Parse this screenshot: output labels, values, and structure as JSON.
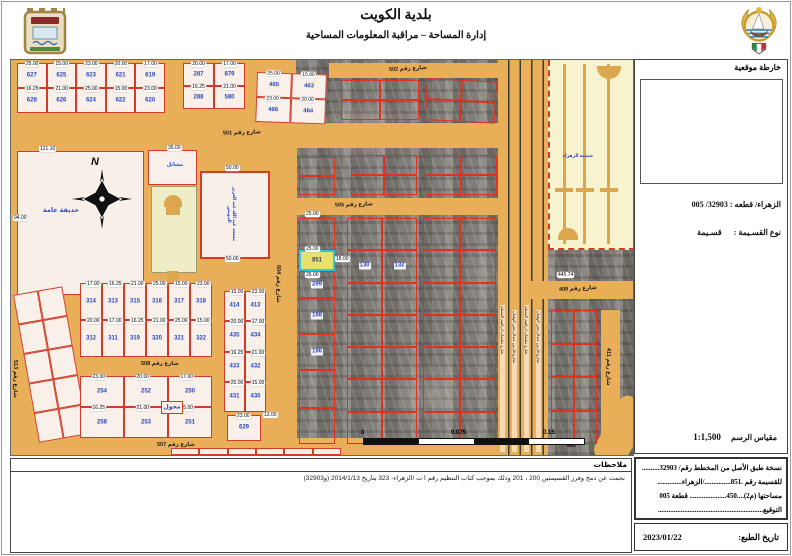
{
  "header": {
    "title": "بلدية الكويت",
    "subtitle": "إدارة المساحة – مراقبة المعلومات المساحية",
    "logo_left": "kuwait-municipality-emblem",
    "logo_right": "kuwait-state-emblem"
  },
  "sidebar": {
    "location_map_label": "خارطة موقعية",
    "area_block_line": "الزهراء/ قطعه :  32903/ 005",
    "parcel_type_label": "نوع القسـيمة :",
    "parcel_type_value": "قسـيمة",
    "scale_label": "مقياس الرسم",
    "scale_value": "1:1,500",
    "certificate": {
      "lines": [
        "نسخة طبق الأصل من المخطط رقم/ 32903..........",
        "للقسيمة رقم .851.............../الزهراء..............",
        "مساحتها (م2)....450..................... قطعة 005",
        "التوقيع............................................................"
      ]
    },
    "print_date_label": "تاريخ الطبع:",
    "print_date_value": "2023/01/22"
  },
  "notes": {
    "title": "ملاحظات",
    "body": "نجمت عن دمج وفرز القسيمتين 200 ، 201 وذلك بموجب كتاب التنظيم رقم ا ت /الزهراء- 323 بتاريخ 2014/1/13 (و32903)"
  },
  "map": {
    "north": "N",
    "highlight_parcel": "851",
    "scale_bar": {
      "zero": "0",
      "mid": "0.075",
      "max": "0.15",
      "unit": "km"
    },
    "median_label": "جمعية الزهراء",
    "lane_street_names": [
      "شارع سليمان ابراهيم المسلم",
      "شارع فارس عبدالرحمن الوقيان"
    ],
    "colors": {
      "street": "#E8AE58",
      "parcel_fill": "#F9F1E9",
      "parcel_outline": "#D23B2A",
      "parcel_number": "#2847C8",
      "highlight_border": "#2BC7DD",
      "highlight_fill": "#E9E16E",
      "median_fill": "#F7F3CF",
      "garden_fill": "#F8F0E8"
    },
    "dim_values": [
      "25.00",
      "15.00",
      "23.00",
      "20.00",
      "17.00",
      "16.25",
      "21.00"
    ],
    "streets": [
      {
        "name": "501",
        "label": "شارع رقم 501",
        "x": 0,
        "y": 63,
        "w": 490,
        "h": 25,
        "lx": 212,
        "ly": 70,
        "rot": -2
      },
      {
        "name": "502",
        "label": "شارع رقم 502",
        "x": 318,
        "y": 3,
        "w": 172,
        "h": 15,
        "lx": 378,
        "ly": 6,
        "rot": -3
      },
      {
        "name": "505",
        "label": "شارع رقم 505",
        "x": 256,
        "y": 138,
        "w": 232,
        "h": 17,
        "lx": 324,
        "ly": 142,
        "rot": -2
      },
      {
        "name": "508",
        "label": "شارع رقم 508",
        "x": 52,
        "y": 297,
        "w": 164,
        "h": 17,
        "lx": 130,
        "ly": 301,
        "rot": 0
      },
      {
        "name": "507",
        "label": "شارع رقم 507",
        "x": 46,
        "y": 378,
        "w": 444,
        "h": 17,
        "lx": 146,
        "ly": 382,
        "rot": 0
      },
      {
        "name": "504",
        "label": "شارع رقم 504",
        "x": 258,
        "y": 60,
        "w": 28,
        "h": 335,
        "vertical": true,
        "lx": 264,
        "ly": 205
      },
      {
        "name": "513",
        "label": "شارع رقم 513",
        "x": 0,
        "y": 88,
        "w": 13,
        "h": 307,
        "vertical": true,
        "lx": 1,
        "ly": 300
      },
      {
        "name": "409",
        "label": "شارع رقم 409",
        "x": 520,
        "y": 221,
        "w": 102,
        "h": 18,
        "lx": 548,
        "ly": 226,
        "rot": -3
      },
      {
        "name": "411",
        "label": "شارع رقم 411",
        "x": 590,
        "y": 250,
        "w": 19,
        "h": 145,
        "vertical": true,
        "lx": 594,
        "ly": 288
      }
    ],
    "blocks": [
      {
        "id": "nw-row",
        "x": 6,
        "y": 3,
        "w": 148,
        "h": 50,
        "rows": 2,
        "cols": 5,
        "chips": true,
        "nums": [
          [
            "627",
            "625",
            "623",
            "621",
            "619"
          ],
          [
            "628",
            "626",
            "624",
            "622",
            "620"
          ]
        ]
      },
      {
        "id": "n-mid",
        "x": 172,
        "y": 3,
        "w": 62,
        "h": 46,
        "rows": 2,
        "cols": 2,
        "chips": true,
        "nums": [
          [
            "287",
            "879"
          ],
          [
            "288",
            "580"
          ]
        ]
      },
      {
        "id": "n-right",
        "x": 246,
        "y": 12,
        "w": 70,
        "h": 50,
        "rows": 2,
        "cols": 2,
        "chips": true,
        "rot": 2,
        "nums": [
          [
            "465",
            "463"
          ],
          [
            "466",
            "464"
          ]
        ]
      },
      {
        "id": "w-col",
        "x": 2,
        "y": 235,
        "w": 50,
        "h": 150,
        "rows": 5,
        "cols": 2,
        "rot": -10,
        "nums": [
          [
            "",
            ""
          ],
          [
            "",
            ""
          ],
          [
            "",
            ""
          ],
          [
            "",
            ""
          ],
          [
            "",
            ""
          ]
        ]
      },
      {
        "id": "c-313",
        "x": 69,
        "y": 223,
        "w": 132,
        "h": 74,
        "rows": 2,
        "cols": 6,
        "chips": true,
        "nums": [
          [
            "314",
            "313",
            "315",
            "316",
            "317",
            "318"
          ],
          [
            "312",
            "311",
            "319",
            "320",
            "321",
            "322"
          ]
        ]
      },
      {
        "id": "c-252",
        "x": 69,
        "y": 316,
        "w": 132,
        "h": 62,
        "rows": 2,
        "cols": 3,
        "chips": true,
        "nums": [
          [
            "254",
            "252",
            "250"
          ],
          [
            "258",
            "253",
            "251"
          ]
        ]
      },
      {
        "id": "muhawwil",
        "x": 150,
        "y": 341,
        "w": 22,
        "h": 13,
        "rows": 1,
        "cols": 1,
        "nums": [
          [
            "محول"
          ]
        ]
      },
      {
        "id": "e-413",
        "x": 213,
        "y": 231,
        "w": 42,
        "h": 121,
        "rows": 4,
        "cols": 2,
        "chips": true,
        "nums": [
          [
            "414",
            "413"
          ],
          [
            "435",
            "434"
          ],
          [
            "433",
            "432"
          ],
          [
            "431",
            "430"
          ]
        ]
      },
      {
        "id": "e-629",
        "x": 216,
        "y": 355,
        "w": 34,
        "h": 26,
        "rows": 1,
        "cols": 1,
        "chips": true,
        "nums": [
          [
            "629"
          ]
        ]
      },
      {
        "id": "a-col-top",
        "x": 288,
        "y": 97,
        "w": 36,
        "h": 38,
        "rows": 2,
        "cols": 1,
        "aerial": true,
        "nums": [
          [
            ""
          ],
          [
            ""
          ]
        ]
      },
      {
        "id": "a-col-851",
        "x": 288,
        "y": 158,
        "w": 36,
        "aerial": true,
        "stack": [
          {
            "h": 32
          },
          {
            "h": 21,
            "n": "851",
            "hl": true
          },
          {
            "h": 27,
            "n": "299"
          },
          {
            "h": 36,
            "n": "198"
          },
          {
            "h": 36,
            "n": "196"
          },
          {
            "h": 38
          },
          {
            "h": 36
          }
        ]
      },
      {
        "id": "a-m1",
        "x": 340,
        "y": 95,
        "w": 66,
        "h": 40,
        "rows": 2,
        "cols": 2,
        "aerial": true
      },
      {
        "id": "a-m2",
        "x": 414,
        "y": 95,
        "w": 72,
        "h": 40,
        "rows": 2,
        "cols": 2,
        "aerial": true
      },
      {
        "id": "a-m3",
        "x": 336,
        "y": 158,
        "w": 70,
        "h": 226,
        "rows": 7,
        "cols": 2,
        "aerial": true,
        "nums": [
          [
            "",
            ""
          ],
          [
            "130",
            "132"
          ],
          [
            "",
            ""
          ],
          [
            "",
            ""
          ],
          [
            "",
            ""
          ],
          [
            "",
            ""
          ],
          [
            "",
            ""
          ]
        ]
      },
      {
        "id": "a-m4",
        "x": 412,
        "y": 158,
        "w": 73,
        "h": 226,
        "rows": 7,
        "cols": 2,
        "aerial": true
      },
      {
        "id": "a-n1",
        "x": 330,
        "y": 20,
        "w": 78,
        "h": 40,
        "rows": 2,
        "cols": 2,
        "aerial": true
      },
      {
        "id": "a-n2",
        "x": 416,
        "y": 18,
        "w": 70,
        "h": 42,
        "rows": 2,
        "cols": 2,
        "aerial": true,
        "rot": 3
      },
      {
        "id": "a-e1",
        "x": 540,
        "y": 250,
        "w": 46,
        "h": 134,
        "rows": 4,
        "cols": 2,
        "aerial": true
      },
      {
        "id": "s-sliver",
        "x": 160,
        "y": 388,
        "w": 170,
        "h": 7,
        "rows": 1,
        "cols": 6
      }
    ],
    "garden": {
      "x": 6,
      "y": 91,
      "w": 125,
      "h": 142,
      "label": "حديقة عامة"
    },
    "landmarks": [
      {
        "text": "حديقة عامة",
        "x": 20,
        "y": 146,
        "w": 60,
        "size": 6.5
      },
      {
        "text": "مشاتل",
        "x": 150,
        "y": 102,
        "w": 28,
        "size": 5
      },
      {
        "text": "مسجد عبد الله عبد العزيز الدويش",
        "x": 216,
        "y": 118,
        "h": 72,
        "vertical": true,
        "size": 4.5
      },
      {
        "text": "جمعية الزهراء",
        "x": 546,
        "y": 93,
        "w": 42,
        "size": 4.5
      }
    ],
    "nursery": {
      "x": 137,
      "y": 90,
      "w": 47,
      "h": 33
    },
    "mosque_plot": {
      "x": 189,
      "y": 111,
      "w": 66,
      "h": 84
    },
    "chips": [
      {
        "t": "121.10",
        "x": 28,
        "y": 86
      },
      {
        "t": "94.00",
        "x": 2,
        "y": 155
      },
      {
        "t": "35.00",
        "x": 156,
        "y": 85
      },
      {
        "t": "50.00",
        "x": 214,
        "y": 105
      },
      {
        "t": "50.00",
        "x": 214,
        "y": 196
      },
      {
        "t": "25.00",
        "x": 294,
        "y": 151
      },
      {
        "t": "25.00",
        "x": 294,
        "y": 186
      },
      {
        "t": "18.00",
        "x": 324,
        "y": 196
      },
      {
        "t": "25.00",
        "x": 294,
        "y": 212
      },
      {
        "t": "445.74",
        "x": 546,
        "y": 212
      },
      {
        "t": "13.00",
        "x": 252,
        "y": 352
      }
    ],
    "lane_labels": [
      {
        "x": 489,
        "y": 245,
        "h": 145,
        "name_index": 0
      },
      {
        "x": 501,
        "y": 250,
        "h": 140,
        "name_index": 1
      },
      {
        "x": 513,
        "y": 245,
        "h": 145,
        "name_index": 0
      },
      {
        "x": 525,
        "y": 250,
        "h": 140,
        "name_index": 1
      }
    ]
  }
}
